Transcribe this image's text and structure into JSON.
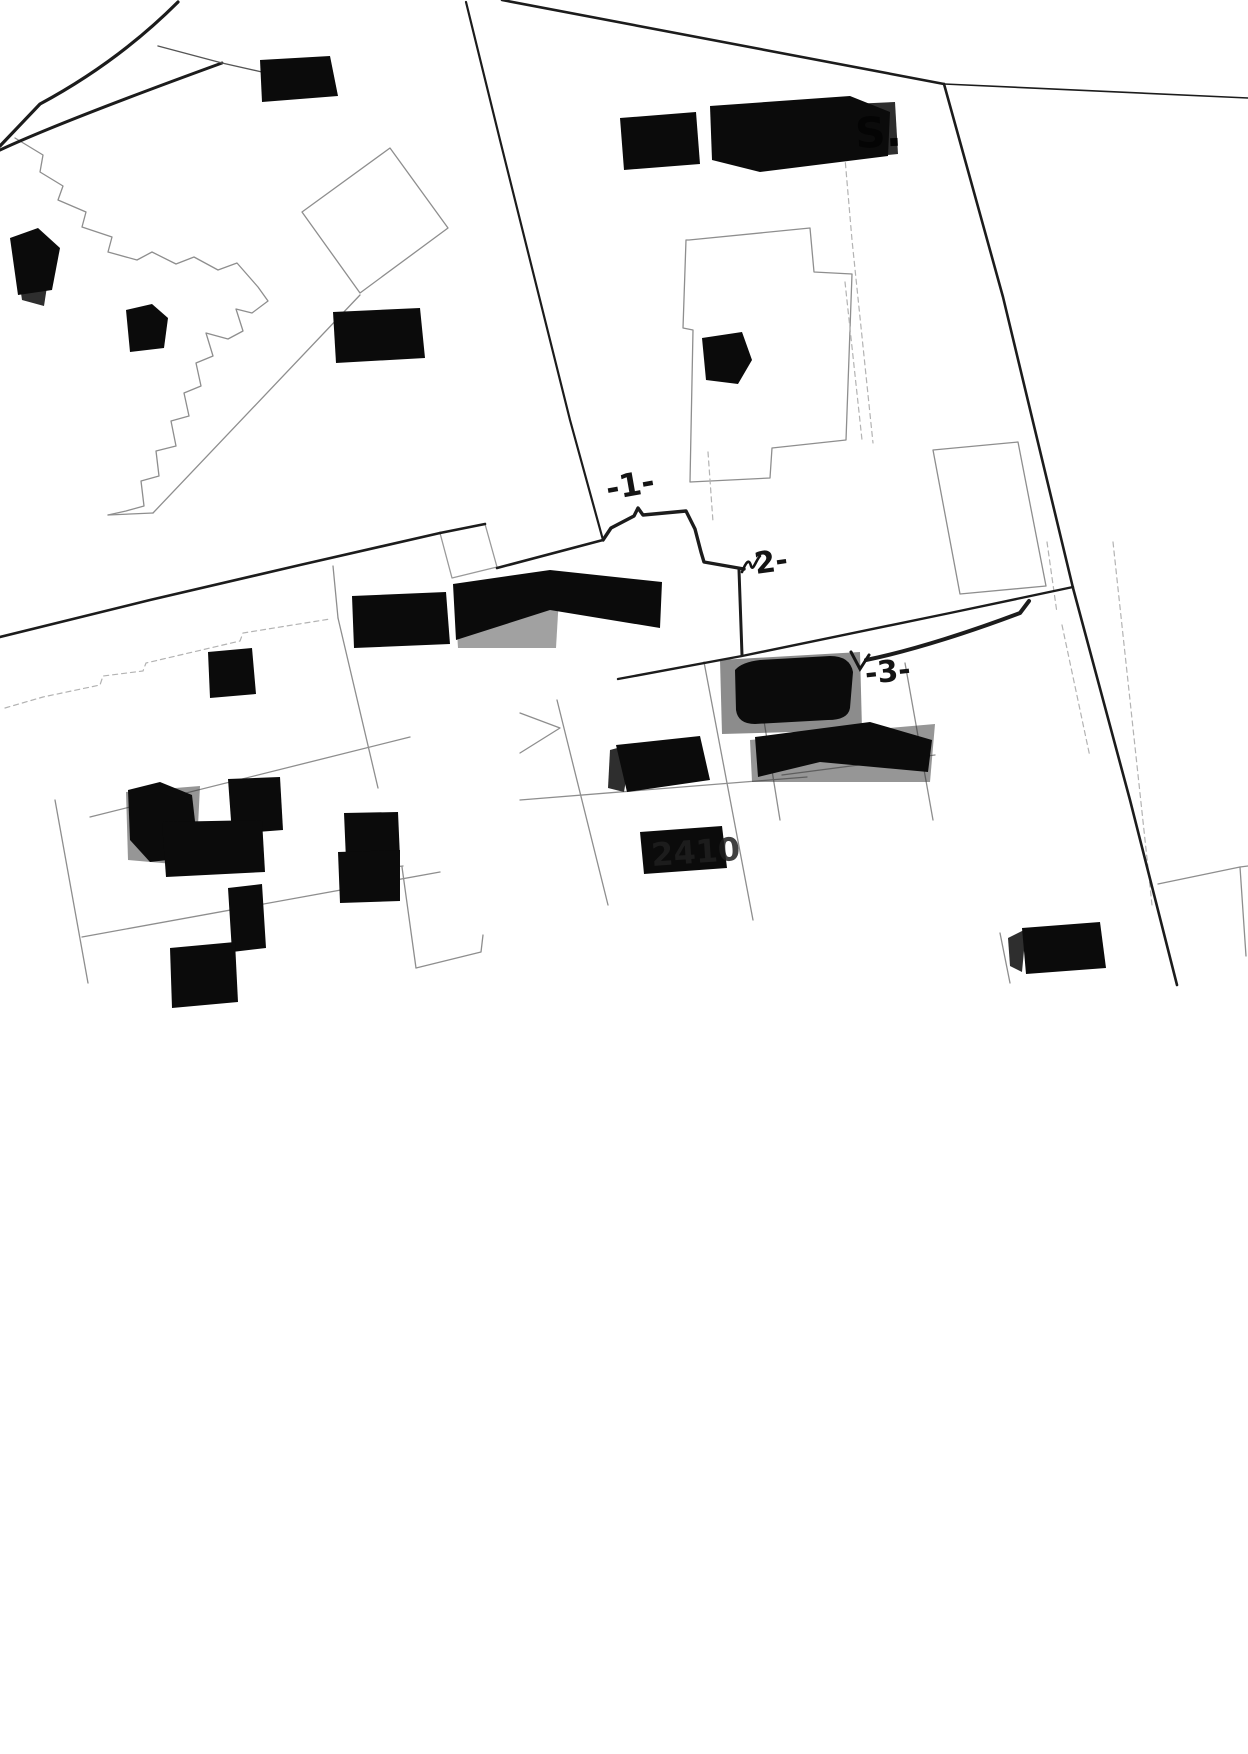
{
  "document": {
    "kind": "scanned cadastral parcel map",
    "background": "#ffffff"
  },
  "annotations": {
    "mark1": "-1-",
    "mark2": "2-",
    "mark3": "-3-"
  },
  "visible_text": {
    "building_label_s": "S.",
    "ghost_digits": "2410"
  },
  "colors": {
    "building_fill": "#0b0b0b",
    "building_fringe": "#2e2e2e",
    "road_line": "#1c1c1c",
    "thin_dark_line": "#555555",
    "parcel_line": "#8e8e8e",
    "parcel_dashed": "#b3b3b3",
    "annotation_ink": "#141414",
    "ghost_ink": "#1f1f1f"
  }
}
